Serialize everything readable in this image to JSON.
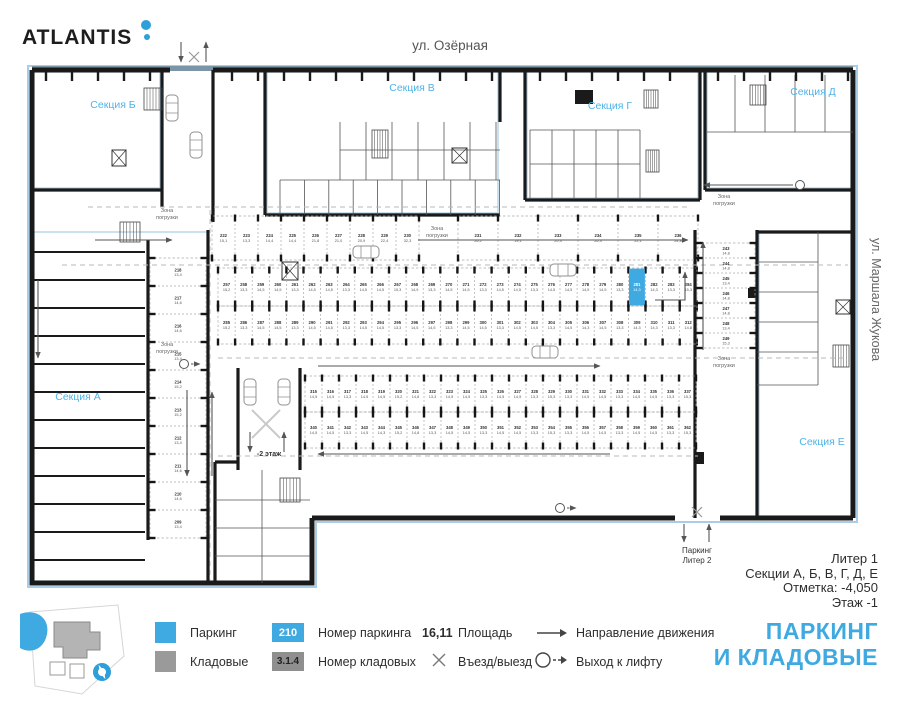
{
  "header": {
    "logo": "ATLANTIS",
    "street_top": "ул. Озёрная",
    "street_right": "ул. Маршала Жукова"
  },
  "colors": {
    "accent": "#3FA9E1",
    "section_label": "#4FB3E8",
    "wall": "#1A1A1A",
    "outline": "#A9CDE6",
    "band": "#7A96A6",
    "storage": "#9A9A9A"
  },
  "plan": {
    "zone_label": "Зона погрузки",
    "ramp_label": "-2 этаж",
    "exit_bottom": {
      "line1": "Паркинг",
      "line2": "Литер 2"
    },
    "sections": [
      {
        "label": "Секция Б",
        "x": 113,
        "y": 108
      },
      {
        "label": "Секция В",
        "x": 412,
        "y": 91
      },
      {
        "label": "Секция Г",
        "x": 610,
        "y": 109
      },
      {
        "label": "Секция Д",
        "x": 813,
        "y": 95
      },
      {
        "label": "Секция А",
        "x": 78,
        "y": 400
      },
      {
        "label": "Секция Е",
        "x": 822,
        "y": 445
      }
    ],
    "zones": [
      {
        "x": 167,
        "y": 212
      },
      {
        "x": 167,
        "y": 346
      },
      {
        "x": 437,
        "y": 230
      },
      {
        "x": 724,
        "y": 198
      },
      {
        "x": 724,
        "y": 360
      }
    ],
    "rows": [
      {
        "orient": "h",
        "x": 212,
        "y": 216,
        "h": 44,
        "sw": 23,
        "stalls": [
          {
            "n": "222",
            "a": "15,1"
          },
          {
            "n": "223",
            "a": "13,3"
          },
          {
            "n": "224",
            "a": "14,4"
          },
          {
            "n": "225",
            "a": "14,4"
          },
          {
            "n": "226",
            "a": "21,8"
          },
          {
            "n": "227",
            "a": "21,0"
          },
          {
            "n": "228",
            "a": "20,9"
          },
          {
            "n": "229",
            "a": "22,4"
          },
          {
            "n": "230",
            "a": "32,3"
          }
        ]
      },
      {
        "orient": "h",
        "x": 458,
        "y": 216,
        "h": 44,
        "sw": 40,
        "stalls": [
          {
            "n": "231",
            "a": "26,2"
          },
          {
            "n": "232",
            "a": "19,1"
          },
          {
            "n": "233",
            "a": "20,3"
          },
          {
            "n": "234",
            "a": "26,3"
          },
          {
            "n": "235",
            "a": "22,1"
          },
          {
            "n": "236",
            "a": "24,8"
          }
        ]
      },
      {
        "orient": "h",
        "x": 218,
        "y": 268,
        "h": 38,
        "sw": 17.1,
        "stalls": [
          {
            "n": "257",
            "a": "15,2"
          },
          {
            "n": "258",
            "a": "13,3"
          },
          {
            "n": "259",
            "a": "14,5"
          },
          {
            "n": "260",
            "a": "14,5"
          },
          {
            "n": "261",
            "a": "13,3"
          },
          {
            "n": "262",
            "a": "14,5"
          },
          {
            "n": "263",
            "a": "14,5"
          },
          {
            "n": "264",
            "a": "13,3"
          },
          {
            "n": "265",
            "a": "14,5"
          },
          {
            "n": "266",
            "a": "14,5"
          },
          {
            "n": "267",
            "a": "15,3"
          },
          {
            "n": "268",
            "a": "14,9"
          },
          {
            "n": "269",
            "a": "13,3"
          },
          {
            "n": "270",
            "a": "14,5"
          },
          {
            "n": "271",
            "a": "14,5"
          },
          {
            "n": "272",
            "a": "13,3"
          },
          {
            "n": "273",
            "a": "14,5"
          },
          {
            "n": "274",
            "a": "14,5"
          },
          {
            "n": "275",
            "a": "13,3"
          },
          {
            "n": "276",
            "a": "14,5"
          },
          {
            "n": "277",
            "a": "14,5"
          },
          {
            "n": "278",
            "a": "14,5"
          },
          {
            "n": "279",
            "a": "14,5"
          },
          {
            "n": "280",
            "a": "13,3"
          },
          {
            "n": "281",
            "a": "14,3",
            "sel": true
          },
          {
            "n": "282",
            "a": "14,3"
          },
          {
            "n": "283",
            "a": "13,3"
          },
          {
            "n": "284",
            "a": "15,3"
          }
        ]
      },
      {
        "orient": "h",
        "x": 218,
        "y": 306,
        "h": 38,
        "sw": 17.1,
        "stalls": [
          {
            "n": "285",
            "a": "15,2"
          },
          {
            "n": "286",
            "a": "13,3"
          },
          {
            "n": "287",
            "a": "14,5"
          },
          {
            "n": "288",
            "a": "14,5"
          },
          {
            "n": "289",
            "a": "13,3"
          },
          {
            "n": "290",
            "a": "14,5"
          },
          {
            "n": "291",
            "a": "14,5"
          },
          {
            "n": "292",
            "a": "13,3"
          },
          {
            "n": "293",
            "a": "14,5"
          },
          {
            "n": "294",
            "a": "14,5"
          },
          {
            "n": "295",
            "a": "13,3"
          },
          {
            "n": "296",
            "a": "14,5"
          },
          {
            "n": "297",
            "a": "14,5"
          },
          {
            "n": "298",
            "a": "13,3"
          },
          {
            "n": "299",
            "a": "14,5"
          },
          {
            "n": "300",
            "a": "14,5"
          },
          {
            "n": "301",
            "a": "13,3"
          },
          {
            "n": "302",
            "a": "14,5"
          },
          {
            "n": "303",
            "a": "14,5"
          },
          {
            "n": "304",
            "a": "13,3"
          },
          {
            "n": "305",
            "a": "14,5"
          },
          {
            "n": "306",
            "a": "14,3"
          },
          {
            "n": "307",
            "a": "14,5"
          },
          {
            "n": "308",
            "a": "13,3"
          },
          {
            "n": "309",
            "a": "14,3"
          },
          {
            "n": "310",
            "a": "14,3"
          },
          {
            "n": "311",
            "a": "13,3"
          },
          {
            "n": "312",
            "a": "14,8"
          }
        ]
      },
      {
        "orient": "h",
        "x": 305,
        "y": 376,
        "h": 36,
        "sw": 17,
        "stalls": [
          {
            "n": "315",
            "a": "14,5"
          },
          {
            "n": "316",
            "a": "14,5"
          },
          {
            "n": "317",
            "a": "13,3"
          },
          {
            "n": "318",
            "a": "14,5"
          },
          {
            "n": "319",
            "a": "14,5"
          },
          {
            "n": "320",
            "a": "15,2"
          },
          {
            "n": "321",
            "a": "14,8"
          },
          {
            "n": "322",
            "a": "13,3"
          },
          {
            "n": "323",
            "a": "14,5"
          },
          {
            "n": "324",
            "a": "14,5"
          },
          {
            "n": "325",
            "a": "13,3"
          },
          {
            "n": "326",
            "a": "14,5"
          },
          {
            "n": "327",
            "a": "14,5"
          },
          {
            "n": "328",
            "a": "13,3"
          },
          {
            "n": "329",
            "a": "15,3"
          },
          {
            "n": "330",
            "a": "13,3"
          },
          {
            "n": "331",
            "a": "14,5"
          },
          {
            "n": "332",
            "a": "14,5"
          },
          {
            "n": "333",
            "a": "13,3"
          },
          {
            "n": "334",
            "a": "14,5"
          },
          {
            "n": "335",
            "a": "14,5"
          },
          {
            "n": "336",
            "a": "13,3"
          },
          {
            "n": "337",
            "a": "15,3"
          }
        ]
      },
      {
        "orient": "h",
        "x": 305,
        "y": 412,
        "h": 36,
        "sw": 17,
        "stalls": [
          {
            "n": "340",
            "a": "14,5"
          },
          {
            "n": "341",
            "a": "14,5"
          },
          {
            "n": "342",
            "a": "13,3"
          },
          {
            "n": "343",
            "a": "14,5"
          },
          {
            "n": "344",
            "a": "14,3"
          },
          {
            "n": "345",
            "a": "15,2"
          },
          {
            "n": "346",
            "a": "14,8"
          },
          {
            "n": "347",
            "a": "13,3"
          },
          {
            "n": "348",
            "a": "14,5"
          },
          {
            "n": "349",
            "a": "14,5"
          },
          {
            "n": "350",
            "a": "13,3"
          },
          {
            "n": "351",
            "a": "14,5"
          },
          {
            "n": "352",
            "a": "14,5"
          },
          {
            "n": "353",
            "a": "13,3"
          },
          {
            "n": "354",
            "a": "15,3"
          },
          {
            "n": "355",
            "a": "13,3"
          },
          {
            "n": "356",
            "a": "14,5"
          },
          {
            "n": "357",
            "a": "14,5"
          },
          {
            "n": "358",
            "a": "13,3"
          },
          {
            "n": "359",
            "a": "14,5"
          },
          {
            "n": "360",
            "a": "14,5"
          },
          {
            "n": "361",
            "a": "13,3"
          },
          {
            "n": "362",
            "a": "15,3"
          }
        ]
      },
      {
        "orient": "v",
        "x": 150,
        "y": 258,
        "w": 56,
        "sh": 28,
        "stalls": [
          {
            "n": "218",
            "a": "13,4"
          },
          {
            "n": "217",
            "a": "14,6"
          },
          {
            "n": "216",
            "a": "14,6"
          },
          {
            "n": "215",
            "a": "13,4"
          },
          {
            "n": "214",
            "a": "15,2"
          },
          {
            "n": "213",
            "a": "15,2"
          },
          {
            "n": "212",
            "a": "13,4"
          },
          {
            "n": "211",
            "a": "14,6"
          },
          {
            "n": "210",
            "a": "14,6"
          },
          {
            "n": "209",
            "a": "13,4"
          }
        ]
      },
      {
        "orient": "v",
        "x": 697,
        "y": 243,
        "w": 58,
        "sh": 15,
        "stalls": [
          {
            "n": "243",
            "a": "14,8"
          },
          {
            "n": "244",
            "a": "14,8"
          },
          {
            "n": "245",
            "a": "13,4"
          },
          {
            "n": "246",
            "a": "14,8"
          },
          {
            "n": "247",
            "a": "14,8"
          },
          {
            "n": "248",
            "a": "13,4"
          },
          {
            "n": "249",
            "a": "15,3"
          }
        ]
      }
    ]
  },
  "footer": {
    "line1": "Литер 1",
    "line2": "Секции А, Б, В, Г, Д, Е",
    "line3": "Отметка: -4,050",
    "line4": "Этаж -1"
  },
  "legend": {
    "parking_label": "Паркинг",
    "storage_label": "Кладовые",
    "parking_badge": "210",
    "parking_num_label": "Номер паркинга",
    "storage_badge": "3.1.4",
    "storage_num_label": "Номер кладовых",
    "area_value": "16,11",
    "area_label": "Площадь",
    "entry_label": "Въезд/выезд",
    "direction_label": "Направление движения",
    "lift_label": "Выход к лифту"
  },
  "title": {
    "line1": "ПАРКИНГ",
    "line2": "И КЛАДОВЫЕ"
  }
}
